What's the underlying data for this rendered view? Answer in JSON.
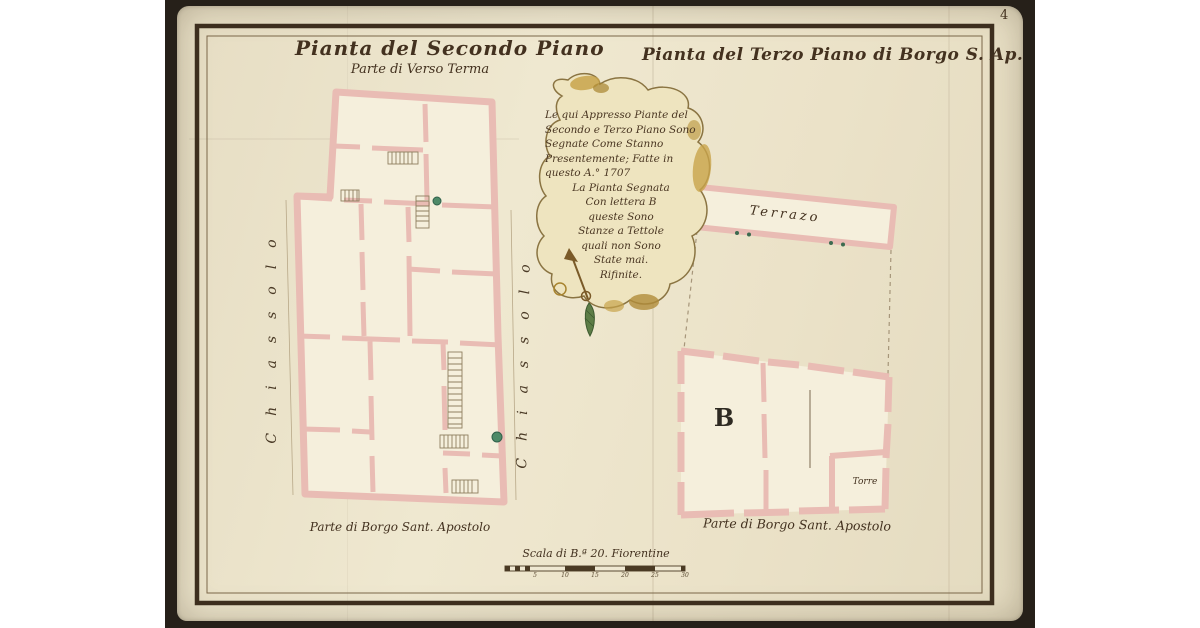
{
  "page": {
    "folio_number": "4",
    "background": "#ffffff",
    "backdrop_color": "#262019",
    "paper_color": "#ebe3ca",
    "ink_color": "#43311f"
  },
  "titles": {
    "left_title": "Pianta del Secondo Piano",
    "left_subtitle": "Parte di Verso Terma",
    "right_title": "Pianta del Terzo Piano di Borgo S. Ap."
  },
  "cartouche": {
    "lines": [
      "Le qui Appresso Piante del",
      "Secondo e Terzo Piano Sono",
      "Segnate Come Stanno",
      "Presentemente; Fatte in",
      "questo A.° 1707",
      "La Pianta Segnata",
      "Con lettera B",
      "queste Sono",
      "Stanze a Tettole",
      "quali non Sono",
      "State mai.",
      "Rifinite."
    ]
  },
  "labels": {
    "terrace": "Terrazo",
    "room_b": "B",
    "tower": "Torre",
    "street_left": "Chiassolo",
    "street_middle": "Chiassolo",
    "bottom_left": "Parte di Borgo Sant. Apostolo",
    "bottom_right": "Parte di Borgo Sant. Apostolo"
  },
  "scale": {
    "caption": "Scala di B.ª 20. Fiorentine",
    "ticks": [
      "5",
      "10",
      "15",
      "20",
      "25",
      "30"
    ]
  },
  "colors": {
    "wall_pink": "#e9bcb4",
    "plan_fill": "#f5efdc",
    "cartouche_fill": "#eee4bf",
    "cartouche_gold": "#c8a44b",
    "green_dot": "#4e8a68",
    "frame": "#3d2e1e"
  }
}
